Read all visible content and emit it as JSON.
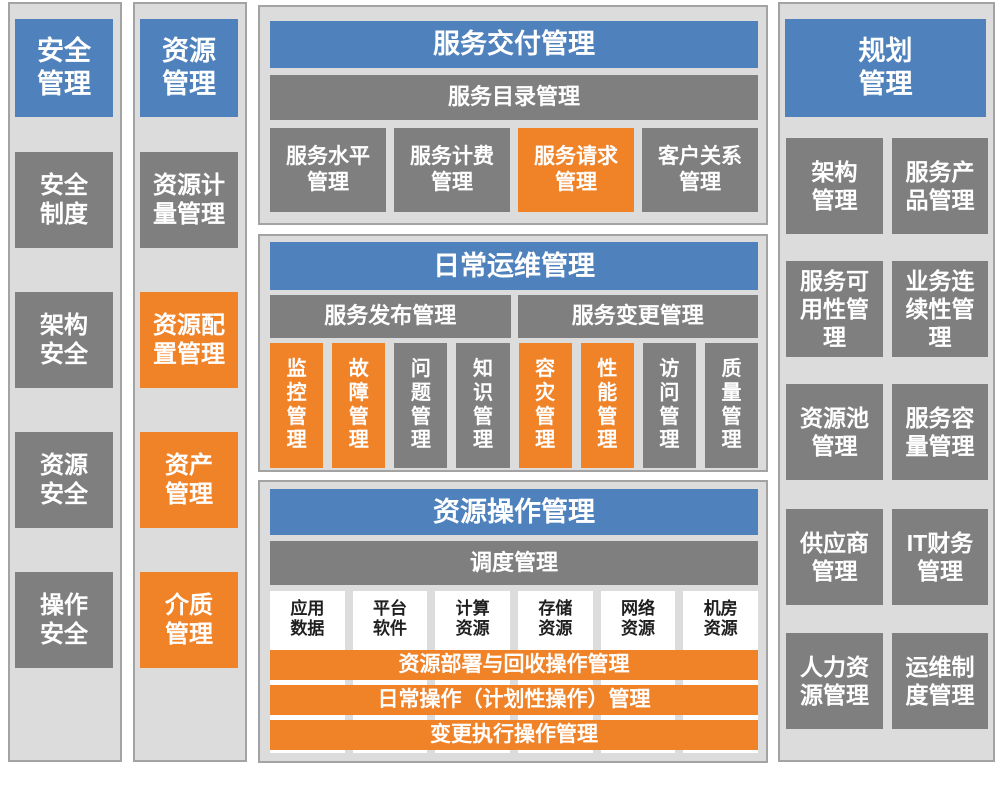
{
  "colors": {
    "blue": "#4F81BD",
    "orange": "#F08228",
    "gray": "#7F7F7F",
    "panel-bg": "#DCDCDC",
    "panel-border": "#A3A3A3",
    "white-box": "#FFFFFF",
    "text-dark": "#1F1F1F"
  },
  "security": {
    "title": "安全\n管理",
    "items": [
      {
        "label": "安全\n制度"
      },
      {
        "label": "架构\n安全"
      },
      {
        "label": "资源\n安全"
      },
      {
        "label": "操作\n安全"
      }
    ]
  },
  "resource": {
    "title": "资源\n管理",
    "items": [
      {
        "label": "资源计\n量管理"
      },
      {
        "label": "资源配\n置管理"
      },
      {
        "label": "资产\n管理"
      },
      {
        "label": "介质\n管理"
      }
    ]
  },
  "service_delivery": {
    "title": "服务交付管理",
    "subtitle_bar": "服务目录管理",
    "boxes": [
      {
        "label": "服务水平\n管理"
      },
      {
        "label": "服务计费\n管理"
      },
      {
        "label": "服务请求\n管理"
      },
      {
        "label": "客户关系\n管理"
      }
    ]
  },
  "daily_operations": {
    "title": "日常运维管理",
    "bars": [
      {
        "label": "服务发布管理"
      },
      {
        "label": "服务变更管理"
      }
    ],
    "boxes": [
      {
        "label": "监\n控\n管\n理"
      },
      {
        "label": "故\n障\n管\n理"
      },
      {
        "label": "问\n题\n管\n理"
      },
      {
        "label": "知\n识\n管\n理"
      },
      {
        "label": "容\n灾\n管\n理"
      },
      {
        "label": "性\n能\n管\n理"
      },
      {
        "label": "访\n问\n管\n理"
      },
      {
        "label": "质\n量\n管\n理"
      }
    ]
  },
  "resource_operations": {
    "title": "资源操作管理",
    "subtitle_bar": "调度管理",
    "columns": [
      {
        "label": "应用\n数据"
      },
      {
        "label": "平台\n软件"
      },
      {
        "label": "计算\n资源"
      },
      {
        "label": "存储\n资源"
      },
      {
        "label": "网络\n资源"
      },
      {
        "label": "机房\n资源"
      }
    ],
    "bars": [
      {
        "label": "资源部署与回收操作管理"
      },
      {
        "label": "日常操作（计划性操作）管理"
      },
      {
        "label": "变更执行操作管理"
      }
    ]
  },
  "planning": {
    "title": "规划\n管理",
    "items": [
      {
        "label": "架构\n管理"
      },
      {
        "label": "服务产\n品管理"
      },
      {
        "label": "服务可\n用性管\n理"
      },
      {
        "label": "业务连\n续性管\n理"
      },
      {
        "label": "资源池\n管理"
      },
      {
        "label": "服务容\n量管理"
      },
      {
        "label": "供应商\n管理"
      },
      {
        "label": "IT财务\n管理"
      },
      {
        "label": "人力资\n源管理"
      },
      {
        "label": "运维制\n度管理"
      }
    ]
  }
}
